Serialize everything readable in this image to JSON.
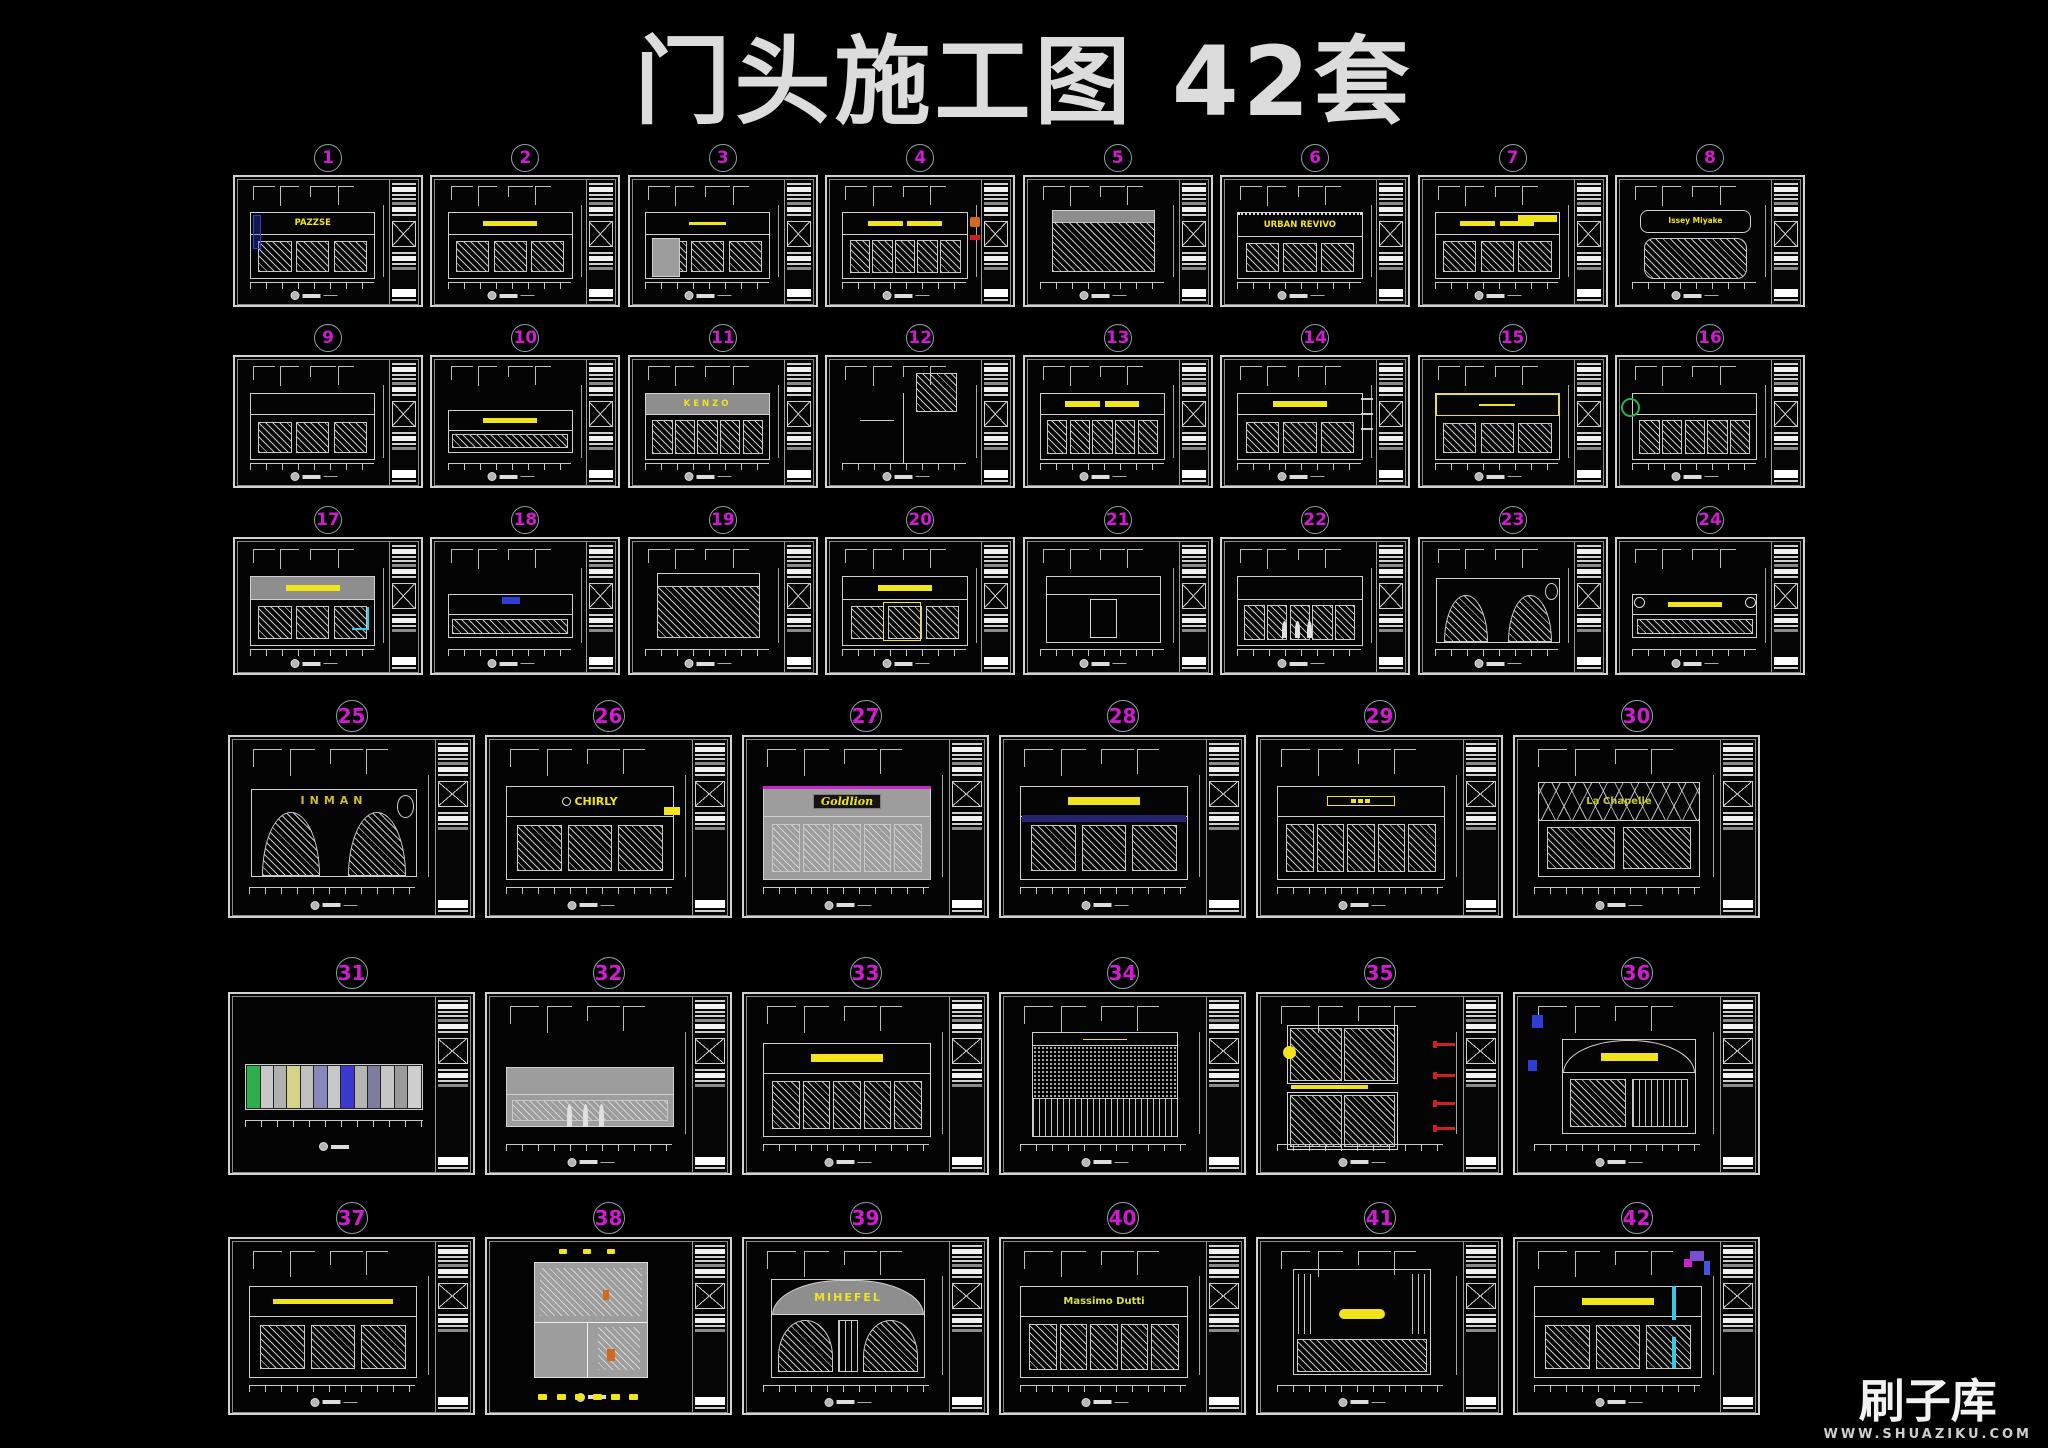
{
  "page": {
    "title": "门头施工图 42套"
  },
  "watermark": {
    "logo": "刷子库",
    "url": "WWW.SHUAZIKU.COM"
  },
  "colors": {
    "number": "#cf1ccf",
    "ring": "#8aa4ac",
    "sign_yellow": "#f2e41c",
    "cyan": "#38c8e8",
    "blue": "#2c3ed6",
    "green": "#22b24c",
    "red": "#d01f1f",
    "orange": "#d2691e",
    "magenta": "#cc22cc",
    "navy": "#23236e",
    "line": "#d0d0d0",
    "facade_gray": "#9d9d9d",
    "title_text": "#dcdcdc"
  },
  "rows": [
    {
      "items": [
        {
          "num": "1",
          "kind": "text",
          "label": "PAZZSE",
          "motif": "panels",
          "accents": [
            "blue-frame"
          ]
        },
        {
          "num": "2",
          "kind": "bar",
          "label": "",
          "motif": "panels",
          "accents": []
        },
        {
          "num": "3",
          "kind": "thin",
          "label": "",
          "motif": "panels",
          "accents": [
            "gray-door"
          ]
        },
        {
          "num": "4",
          "kind": "double",
          "label": "",
          "motif": "glazing",
          "accents": [
            "color-logo"
          ]
        },
        {
          "num": "5",
          "kind": "none",
          "label": "",
          "motif": "bigpanel",
          "accents": [
            "gray-band"
          ]
        },
        {
          "num": "6",
          "kind": "text",
          "label": "URBAN REVIVO",
          "motif": "panels",
          "accents": [
            "dotted-top"
          ]
        },
        {
          "num": "7",
          "kind": "double",
          "label": "",
          "motif": "panels",
          "accents": [
            "bar-topright"
          ]
        },
        {
          "num": "8",
          "kind": "text",
          "label": "Issey Miyake",
          "motif": "rounded",
          "accents": [],
          "sign_style": {
            "fs_delta": -1
          }
        }
      ]
    },
    {
      "items": [
        {
          "num": "9",
          "kind": "none",
          "label": "",
          "motif": "panels",
          "accents": []
        },
        {
          "num": "10",
          "kind": "bar",
          "label": "",
          "motif": "low",
          "accents": []
        },
        {
          "num": "11",
          "kind": "text",
          "label": "KENZO",
          "motif": "glazing",
          "accents": [
            "gray-band"
          ],
          "sign_style": {
            "letter_spacing": 3
          }
        },
        {
          "num": "12",
          "kind": "none",
          "label": "",
          "motif": "narrow",
          "accents": []
        },
        {
          "num": "13",
          "kind": "double",
          "label": "",
          "motif": "glazing",
          "accents": []
        },
        {
          "num": "14",
          "kind": "bar",
          "label": "",
          "motif": "panels",
          "accents": [
            "detail-right"
          ]
        },
        {
          "num": "15",
          "kind": "thin",
          "label": "",
          "motif": "panels",
          "accents": [
            "yellow-frame-band"
          ]
        },
        {
          "num": "16",
          "kind": "none",
          "label": "",
          "motif": "glazing",
          "accents": [
            "green-logo"
          ]
        }
      ]
    },
    {
      "items": [
        {
          "num": "17",
          "kind": "bar",
          "label": "",
          "motif": "panels",
          "accents": [
            "gray-band",
            "cyan-accent"
          ]
        },
        {
          "num": "18",
          "kind": "none",
          "label": "",
          "motif": "low",
          "accents": [
            "blue-sign"
          ]
        },
        {
          "num": "19",
          "kind": "none",
          "label": "",
          "motif": "bigpanel",
          "accents": []
        },
        {
          "num": "20",
          "kind": "bar",
          "label": "",
          "motif": "panels",
          "accents": [
            "yellow-frame"
          ]
        },
        {
          "num": "21",
          "kind": "none",
          "label": "",
          "motif": "simple",
          "accents": []
        },
        {
          "num": "22",
          "kind": "none",
          "label": "",
          "motif": "glazing",
          "accents": [
            "figures"
          ]
        },
        {
          "num": "23",
          "kind": "none",
          "label": "",
          "motif": "arches2",
          "accents": []
        },
        {
          "num": "24",
          "kind": "bar",
          "label": "",
          "motif": "low",
          "accents": [
            "end-circles"
          ]
        }
      ]
    },
    {
      "items": [
        {
          "num": "25",
          "kind": "text",
          "label": "INMAN",
          "motif": "arches2",
          "accents": [],
          "sign_style": {
            "letter_spacing": 5,
            "color": "#cfbb30"
          }
        },
        {
          "num": "26",
          "kind": "text",
          "label": "CHIRLY",
          "motif": "panels",
          "accents": [
            "yellow-blob-right",
            "circle-logo"
          ]
        },
        {
          "num": "27",
          "kind": "text",
          "label": "Goldlion",
          "motif": "glazing",
          "accents": [
            "magenta-stripe",
            "gray-face"
          ],
          "sign_style": {
            "script": true,
            "backing": true
          }
        },
        {
          "num": "28",
          "kind": "bar",
          "label": "",
          "motif": "panels",
          "accents": [
            "navy-underband"
          ]
        },
        {
          "num": "29",
          "kind": "outline",
          "label": "",
          "motif": "glazing",
          "accents": []
        },
        {
          "num": "30",
          "kind": "text",
          "label": "La Chapelle",
          "motif": "truss",
          "accents": [],
          "sign_style": {
            "color": "#c8c832",
            "fs_delta": -1
          }
        }
      ]
    },
    {
      "items": [
        {
          "num": "31",
          "kind": "none",
          "label": "",
          "motif": "plan-strip",
          "accents": [
            "colored-plan"
          ]
        },
        {
          "num": "32",
          "kind": "none",
          "label": "",
          "motif": "low",
          "accents": [
            "gray-face",
            "figures"
          ]
        },
        {
          "num": "33",
          "kind": "bar",
          "label": "",
          "motif": "glazing",
          "accents": []
        },
        {
          "num": "34",
          "kind": "thin",
          "label": "",
          "motif": "speckle",
          "accents": []
        },
        {
          "num": "35",
          "kind": "none",
          "label": "",
          "motif": "windows2",
          "accents": [
            "red-callouts",
            "yellow-lamp",
            "yellow-underbar"
          ]
        },
        {
          "num": "36",
          "kind": "bar",
          "label": "",
          "motif": "arch",
          "accents": [
            "blue-squares"
          ]
        }
      ]
    },
    {
      "items": [
        {
          "num": "37",
          "kind": "bar-wide",
          "label": "",
          "motif": "panels",
          "accents": []
        },
        {
          "num": "38",
          "kind": "none",
          "label": "",
          "motif": "plan-room",
          "accents": [
            "orange-bits",
            "yellow-stamps"
          ]
        },
        {
          "num": "39",
          "kind": "text",
          "label": "MIHEFEL",
          "motif": "arch-doors",
          "accents": [],
          "sign_style": {
            "letter_spacing": 2
          }
        },
        {
          "num": "40",
          "kind": "text",
          "label": "Massimo Dutti",
          "motif": "glazing",
          "accents": [],
          "sign_style": {
            "fs_delta": -1,
            "color": "#d8e048"
          }
        },
        {
          "num": "41",
          "kind": "capsule",
          "label": "",
          "motif": "simple2",
          "accents": []
        },
        {
          "num": "42",
          "kind": "bar",
          "label": "",
          "motif": "panels",
          "accents": [
            "cyan-bars",
            "purple-detail"
          ]
        }
      ]
    }
  ]
}
